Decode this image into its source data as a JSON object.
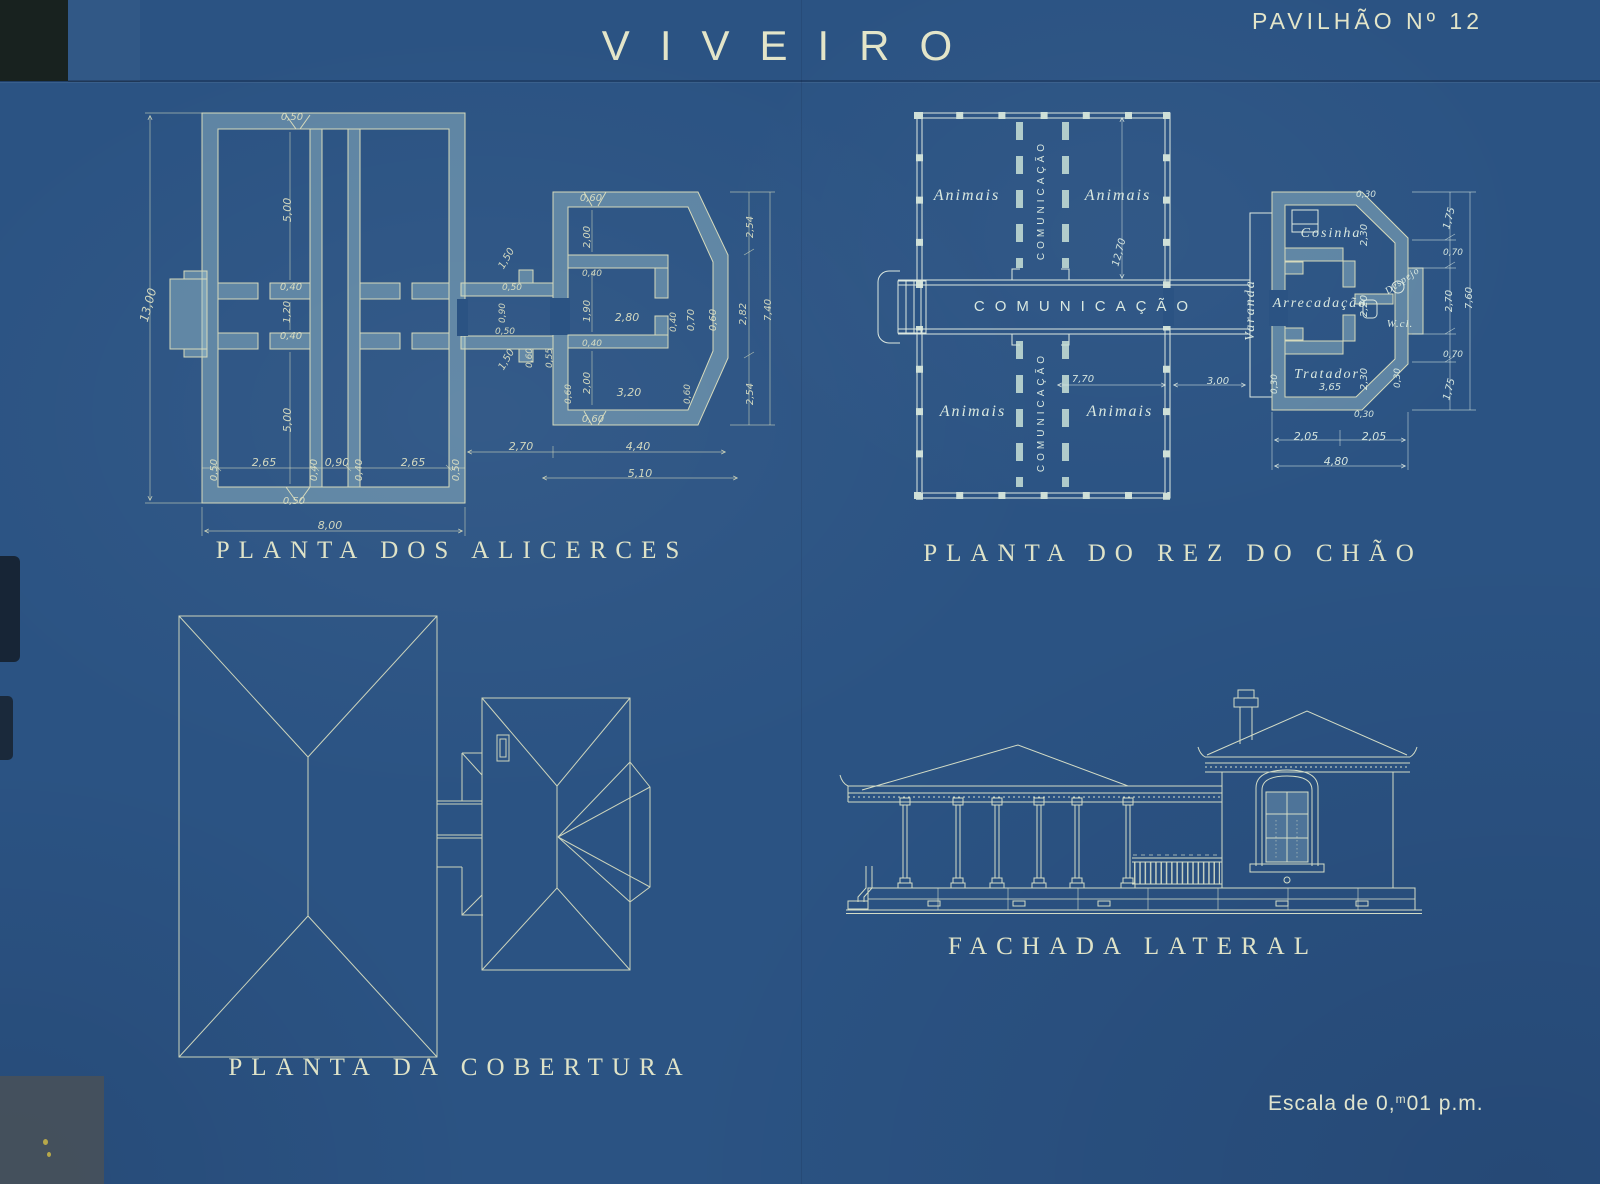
{
  "title": "VIVEIRO",
  "sheet_no": "PAVILHÃO Nº 12",
  "scale": {
    "prefix": "Escala de 0,",
    "sup": "m",
    "suffix": "01 p.m."
  },
  "colors": {
    "background": "#2b5383",
    "line_foundation": "#d6dabc",
    "line_ground_plan": "#dce8e0",
    "line_roof_plan": "#ccd4bc",
    "line_facade": "#d3dcc6",
    "wall_fill": "#a8cbd2"
  },
  "drawings": {
    "alicerces": {
      "caption": "PLANTA DOS ALICERCES",
      "labels": [
        {
          "t": "13,00",
          "x": 152,
          "y": 306,
          "r": -75,
          "s": 12
        },
        {
          "t": "0,50",
          "x": 292,
          "y": 120,
          "s": 10
        },
        {
          "t": "5,00",
          "x": 291,
          "y": 210,
          "r": -90,
          "s": 11
        },
        {
          "t": "0,40",
          "x": 291,
          "y": 290,
          "s": 10
        },
        {
          "t": "1,20",
          "x": 290,
          "y": 312,
          "r": -90,
          "s": 10
        },
        {
          "t": "0,40",
          "x": 291,
          "y": 339,
          "s": 10
        },
        {
          "t": "5,00",
          "x": 291,
          "y": 420,
          "r": -90,
          "s": 11
        },
        {
          "t": "0,50",
          "x": 217,
          "y": 470,
          "r": -90,
          "s": 10
        },
        {
          "t": "2,65",
          "x": 264,
          "y": 466,
          "s": 11
        },
        {
          "t": "0,40",
          "x": 317,
          "y": 470,
          "r": -90,
          "s": 10
        },
        {
          "t": "0,90",
          "x": 337,
          "y": 466,
          "s": 11
        },
        {
          "t": "0,40",
          "x": 362,
          "y": 470,
          "r": -90,
          "s": 10
        },
        {
          "t": "2,65",
          "x": 413,
          "y": 466,
          "s": 11
        },
        {
          "t": "0,50",
          "x": 459,
          "y": 470,
          "r": -90,
          "s": 10
        },
        {
          "t": "0,50",
          "x": 294,
          "y": 504,
          "s": 10
        },
        {
          "t": "8,00",
          "x": 330,
          "y": 529,
          "s": 11
        },
        {
          "t": "1,50",
          "x": 509,
          "y": 260,
          "r": -60,
          "s": 10
        },
        {
          "t": "0,50",
          "x": 512,
          "y": 290,
          "s": 9
        },
        {
          "t": "0,90",
          "x": 505,
          "y": 313,
          "r": -90,
          "s": 9
        },
        {
          "t": "0,50",
          "x": 505,
          "y": 334,
          "s": 9
        },
        {
          "t": "1,50",
          "x": 509,
          "y": 361,
          "r": -60,
          "s": 10
        },
        {
          "t": "0,60",
          "x": 532,
          "y": 358,
          "r": -90,
          "s": 9
        },
        {
          "t": "0,55",
          "x": 552,
          "y": 358,
          "r": -90,
          "s": 9
        },
        {
          "t": "0,60",
          "x": 591,
          "y": 201,
          "s": 10
        },
        {
          "t": "2,00",
          "x": 590,
          "y": 237,
          "r": -90,
          "s": 10
        },
        {
          "t": "0,40",
          "x": 592,
          "y": 276,
          "s": 9
        },
        {
          "t": "1,90",
          "x": 590,
          "y": 311,
          "r": -90,
          "s": 10
        },
        {
          "t": "2,80",
          "x": 627,
          "y": 321,
          "s": 11
        },
        {
          "t": "0,40",
          "x": 676,
          "y": 322,
          "r": -90,
          "s": 9
        },
        {
          "t": "0,70",
          "x": 694,
          "y": 320,
          "r": -90,
          "s": 10
        },
        {
          "t": "0,60",
          "x": 716,
          "y": 320,
          "r": -90,
          "s": 10
        },
        {
          "t": "0,40",
          "x": 592,
          "y": 346,
          "s": 9
        },
        {
          "t": "2,00",
          "x": 590,
          "y": 383,
          "r": -90,
          "s": 10
        },
        {
          "t": "0,60",
          "x": 571,
          "y": 394,
          "r": -90,
          "s": 9
        },
        {
          "t": "3,20",
          "x": 629,
          "y": 396,
          "s": 11
        },
        {
          "t": "0,60",
          "x": 690,
          "y": 394,
          "r": -90,
          "s": 9
        },
        {
          "t": "0,60",
          "x": 593,
          "y": 422,
          "s": 10
        },
        {
          "t": "2,70",
          "x": 521,
          "y": 450,
          "s": 11
        },
        {
          "t": "4,40",
          "x": 638,
          "y": 450,
          "s": 11
        },
        {
          "t": "5,10",
          "x": 640,
          "y": 477,
          "s": 11
        },
        {
          "t": "2,54",
          "x": 753,
          "y": 227,
          "r": -90,
          "s": 10
        },
        {
          "t": "2,82",
          "x": 746,
          "y": 314,
          "r": -90,
          "s": 10
        },
        {
          "t": "7,40",
          "x": 771,
          "y": 310,
          "r": -90,
          "s": 10
        },
        {
          "t": "2,54",
          "x": 753,
          "y": 394,
          "r": -90,
          "s": 10
        }
      ]
    },
    "rez_do_chao": {
      "caption": "PLANTA DO REZ DO CHÃO",
      "labels": [
        {
          "t": "Animais",
          "x": 967,
          "y": 200,
          "c": "room",
          "s": 16
        },
        {
          "t": "Animais",
          "x": 1118,
          "y": 200,
          "c": "room",
          "s": 16
        },
        {
          "t": "Animais",
          "x": 973,
          "y": 416,
          "c": "room",
          "s": 16
        },
        {
          "t": "Animais",
          "x": 1120,
          "y": 416,
          "c": "room",
          "s": 16
        },
        {
          "t": "COMUNICAÇÃO",
          "x": 1086,
          "y": 311,
          "c": "corr",
          "s": 15
        },
        {
          "t": "COMUNICAÇÃO",
          "x": 1044,
          "y": 200,
          "r": -90,
          "c": "corrv",
          "s": 10
        },
        {
          "t": "COMUNICAÇÃO",
          "x": 1044,
          "y": 412,
          "r": -90,
          "c": "corrv",
          "s": 10
        },
        {
          "t": "12,70",
          "x": 1122,
          "y": 253,
          "r": -75,
          "s": 10,
          "c": "dimb"
        },
        {
          "t": "7,70",
          "x": 1083,
          "y": 382,
          "s": 10,
          "c": "dimb"
        },
        {
          "t": "3,00",
          "x": 1218,
          "y": 384,
          "s": 10,
          "c": "dimb"
        },
        {
          "t": "Varanda",
          "x": 1254,
          "y": 310,
          "r": -90,
          "c": "room",
          "s": 14
        },
        {
          "t": "Cosinha",
          "x": 1331,
          "y": 237,
          "c": "room",
          "s": 14
        },
        {
          "t": "2,30",
          "x": 1367,
          "y": 235,
          "r": -90,
          "s": 10,
          "c": "dimb"
        },
        {
          "t": "Arrecadação",
          "x": 1320,
          "y": 307,
          "c": "room",
          "s": 14
        },
        {
          "t": "2,20",
          "x": 1367,
          "y": 306,
          "r": -90,
          "s": 10,
          "c": "dimb"
        },
        {
          "t": "Despejo",
          "x": 1404,
          "y": 283,
          "r": -35,
          "c": "rooms",
          "s": 10
        },
        {
          "t": "W.cl.",
          "x": 1400,
          "y": 327,
          "c": "rooms",
          "s": 11
        },
        {
          "t": "Tratador",
          "x": 1327,
          "y": 378,
          "c": "room",
          "s": 14
        },
        {
          "t": "3,65",
          "x": 1330,
          "y": 390,
          "s": 10,
          "c": "dimb"
        },
        {
          "t": "2,30",
          "x": 1367,
          "y": 379,
          "r": -90,
          "s": 10,
          "c": "dimb"
        },
        {
          "t": "0,30",
          "x": 1366,
          "y": 197,
          "s": 9,
          "c": "dimb"
        },
        {
          "t": "0,30",
          "x": 1277,
          "y": 384,
          "r": -90,
          "s": 9,
          "c": "dimb"
        },
        {
          "t": "0,30",
          "x": 1400,
          "y": 378,
          "r": -90,
          "s": 9,
          "c": "dimb"
        },
        {
          "t": "0,30",
          "x": 1364,
          "y": 417,
          "s": 9,
          "c": "dimb"
        },
        {
          "t": "2,05",
          "x": 1306,
          "y": 440,
          "s": 11,
          "c": "dimb"
        },
        {
          "t": "2,05",
          "x": 1374,
          "y": 440,
          "s": 11,
          "c": "dimb"
        },
        {
          "t": "4,80",
          "x": 1336,
          "y": 465,
          "s": 11,
          "c": "dimb"
        },
        {
          "t": "1,75",
          "x": 1452,
          "y": 219,
          "r": -75,
          "s": 10,
          "c": "dimb"
        },
        {
          "t": "0,70",
          "x": 1453,
          "y": 255,
          "s": 9,
          "c": "dimb"
        },
        {
          "t": "2,70",
          "x": 1452,
          "y": 301,
          "r": -90,
          "s": 10,
          "c": "dimb"
        },
        {
          "t": "7,60",
          "x": 1472,
          "y": 298,
          "r": -90,
          "s": 10,
          "c": "dimb"
        },
        {
          "t": "0,70",
          "x": 1453,
          "y": 357,
          "s": 9,
          "c": "dimb"
        },
        {
          "t": "1,75",
          "x": 1452,
          "y": 390,
          "r": -75,
          "s": 10,
          "c": "dimb"
        }
      ]
    },
    "cobertura": {
      "caption": "PLANTA DA COBERTURA",
      "labels": []
    },
    "fachada": {
      "caption": "FACHADA LATERAL",
      "labels": []
    }
  }
}
